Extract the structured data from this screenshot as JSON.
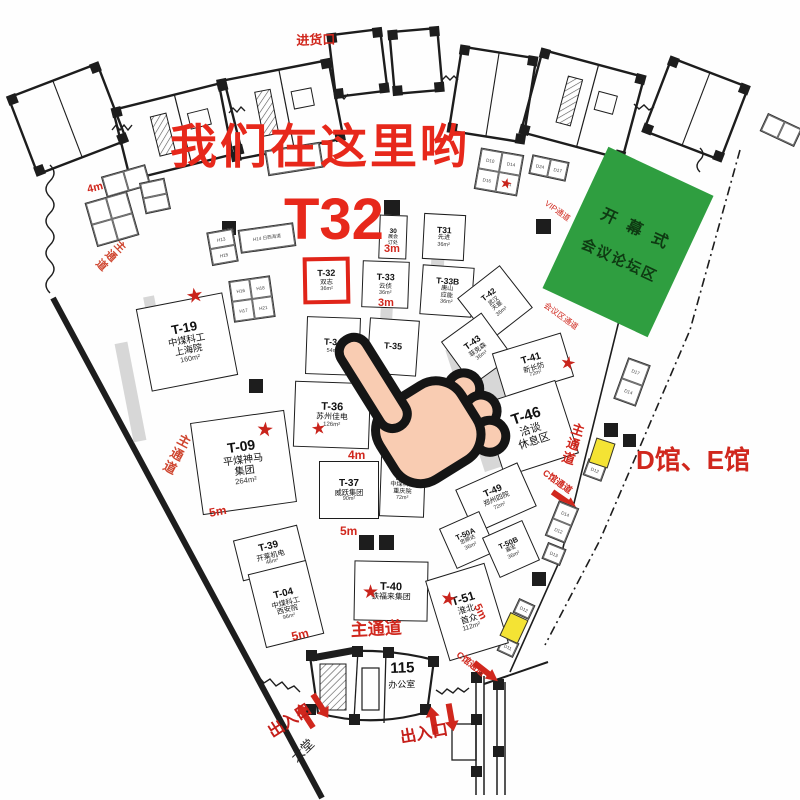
{
  "colors": {
    "accent_red": "#d0271d",
    "highlight_red": "#e02419",
    "green_area": "#2f9e40",
    "yellow_booth": "#f4e334"
  },
  "annotations": {
    "headline": "我们在这里哟",
    "booth_code": "T32"
  },
  "green_area": {
    "line1": "开幕式",
    "line2": "会议论坛区"
  },
  "booths": [
    {
      "id": "T-19",
      "n": [
        "中煤科工",
        "上海院"
      ],
      "a": "160m²",
      "x": 143,
      "y": 300,
      "w": 88,
      "h": 84,
      "r": -11,
      "fs": 13
    },
    {
      "id": "T-09",
      "n": [
        "平煤神马",
        "集团"
      ],
      "a": "264m²",
      "x": 196,
      "y": 416,
      "w": 95,
      "h": 93,
      "r": -8,
      "fs": 14
    },
    {
      "id": "T-39",
      "n": [
        "开莱机电"
      ],
      "a": "48m²",
      "x": 237,
      "y": 532,
      "w": 66,
      "h": 42,
      "r": -14,
      "fs": 10
    },
    {
      "id": "T-04",
      "n": [
        "中煤科工",
        "西安院"
      ],
      "a": "96m²",
      "x": 256,
      "y": 566,
      "w": 60,
      "h": 76,
      "r": -14,
      "fs": 10
    },
    {
      "id": "30",
      "n": [
        "展会",
        "订处"
      ],
      "a": "",
      "x": 379,
      "y": 215,
      "w": 28,
      "h": 44,
      "r": 2,
      "fs": 6.5
    },
    {
      "id": "T31",
      "n": [
        "先进"
      ],
      "a": "36m²",
      "x": 423,
      "y": 214,
      "w": 42,
      "h": 46,
      "r": 3,
      "fs": 8.5
    },
    {
      "id": "T-32",
      "n": [
        "双志"
      ],
      "a": "36m²",
      "x": 303,
      "y": 257,
      "w": 47,
      "h": 47,
      "r": -1,
      "fs": 9,
      "hl": true
    },
    {
      "id": "T-33",
      "n": [
        "云侦"
      ],
      "a": "36m²",
      "x": 362,
      "y": 261,
      "w": 47,
      "h": 47,
      "r": 2,
      "fs": 9
    },
    {
      "id": "T-33B",
      "n": [
        "唐山",
        "应能"
      ],
      "a": "36m²",
      "x": 421,
      "y": 266,
      "w": 52,
      "h": 50,
      "r": 4,
      "fs": 8.5
    },
    {
      "id": "T-42",
      "n": [
        "武汉",
        "天宸"
      ],
      "a": "36m²",
      "x": 468,
      "y": 276,
      "w": 54,
      "h": 54,
      "r": -38,
      "fs": 8
    },
    {
      "id": "T-34",
      "n": [],
      "a": "54m²",
      "x": 306,
      "y": 317,
      "w": 54,
      "h": 58,
      "r": 2,
      "fs": 9
    },
    {
      "id": "T-35",
      "n": [],
      "a": "",
      "x": 368,
      "y": 319,
      "w": 50,
      "h": 56,
      "r": 4,
      "fs": 9
    },
    {
      "id": "T-36",
      "n": [
        "苏州佳电"
      ],
      "a": "126m²",
      "x": 294,
      "y": 382,
      "w": 76,
      "h": 66,
      "r": 2,
      "fs": 11
    },
    {
      "id": "T-37",
      "n": [
        "威跃集团"
      ],
      "a": "90m²",
      "x": 319,
      "y": 461,
      "w": 60,
      "h": 58,
      "r": 0,
      "fs": 10
    },
    {
      "id": "T-38",
      "n": [
        "中煤科工",
        "重庆院"
      ],
      "a": "72m²",
      "x": 380,
      "y": 457,
      "w": 45,
      "h": 60,
      "r": 2,
      "fs": 8.5
    },
    {
      "id": "T-40",
      "n": [
        "铁福来集团"
      ],
      "a": "",
      "x": 354,
      "y": 561,
      "w": 74,
      "h": 60,
      "r": 1,
      "fs": 11
    },
    {
      "id": "T-43",
      "n": [
        "菲克森"
      ],
      "a": "36m²",
      "x": 452,
      "y": 322,
      "w": 50,
      "h": 54,
      "r": -36,
      "fs": 9
    },
    {
      "id": "T-41",
      "n": [
        "新长防"
      ],
      "a": "72m²",
      "x": 497,
      "y": 342,
      "w": 72,
      "h": 46,
      "r": -17,
      "fs": 10
    },
    {
      "id": "T-46",
      "n": [
        "洽谈",
        "休息区"
      ],
      "a": "",
      "x": 491,
      "y": 390,
      "w": 78,
      "h": 77,
      "r": -18,
      "fs": 15
    },
    {
      "id": "T-49",
      "n": [
        "郑州四院"
      ],
      "a": "72m²",
      "x": 462,
      "y": 474,
      "w": 68,
      "h": 48,
      "r": -24,
      "fs": 9.5
    },
    {
      "id": "T-50A",
      "n": [
        "忠顺达"
      ],
      "a": "36m²",
      "x": 446,
      "y": 518,
      "w": 44,
      "h": 44,
      "r": -24,
      "fs": 7.5
    },
    {
      "id": "T-50B",
      "n": [
        "嘉宏"
      ],
      "a": "36m²",
      "x": 489,
      "y": 527,
      "w": 44,
      "h": 44,
      "r": -24,
      "fs": 7.5
    },
    {
      "id": "T-51",
      "n": [
        "淮北",
        "首众"
      ],
      "a": "112m²",
      "x": 436,
      "y": 570,
      "w": 62,
      "h": 84,
      "r": -17,
      "fs": 12
    }
  ],
  "mini_clusters": [
    {
      "cells": [
        "",
        ""
      ],
      "cols": 2,
      "x": 103,
      "y": 170,
      "w": 46,
      "h": 22,
      "r": -16
    },
    {
      "cells": [
        "",
        "",
        "",
        ""
      ],
      "cols": 2,
      "x": 90,
      "y": 196,
      "w": 44,
      "h": 46,
      "r": -16
    },
    {
      "cells": [
        "",
        ""
      ],
      "cols": 1,
      "x": 142,
      "y": 180,
      "w": 26,
      "h": 32,
      "r": -12
    },
    {
      "cells": [
        ""
      ],
      "cols": 1,
      "x": 266,
      "y": 146,
      "w": 56,
      "h": 26,
      "r": -9
    },
    {
      "cells": [
        "H13",
        "H15"
      ],
      "cols": 1,
      "x": 209,
      "y": 230,
      "w": 27,
      "h": 34,
      "r": -10
    },
    {
      "cells": [
        "H14 日西海道"
      ],
      "cols": 1,
      "x": 239,
      "y": 226,
      "w": 56,
      "h": 24,
      "r": -8
    },
    {
      "cells": [
        "H16",
        "H18",
        "H17",
        "H21"
      ],
      "cols": 2,
      "x": 231,
      "y": 278,
      "w": 42,
      "h": 42,
      "r": -8
    },
    {
      "cells": [
        "D10",
        "D14",
        "D16",
        "D11"
      ],
      "cols": 2,
      "x": 477,
      "y": 151,
      "w": 44,
      "h": 42,
      "r": 10
    },
    {
      "cells": [
        "D24",
        "D17"
      ],
      "cols": 2,
      "x": 530,
      "y": 158,
      "w": 38,
      "h": 20,
      "r": 12
    },
    {
      "cells": [
        "D17",
        "D14"
      ],
      "cols": 1,
      "x": 620,
      "y": 360,
      "w": 24,
      "h": 44,
      "r": 20
    },
    {
      "cells": [
        "D12"
      ],
      "cols": 1,
      "x": 585,
      "y": 461,
      "w": 20,
      "h": 18,
      "r": 20
    },
    {
      "cells": [
        "D14",
        "D12"
      ],
      "cols": 1,
      "x": 551,
      "y": 503,
      "w": 22,
      "h": 38,
      "r": 22
    },
    {
      "cells": [
        "D13"
      ],
      "cols": 1,
      "x": 544,
      "y": 545,
      "w": 20,
      "h": 18,
      "r": 22
    },
    {
      "cells": [
        "D12"
      ],
      "cols": 1,
      "x": 515,
      "y": 601,
      "w": 18,
      "h": 16,
      "r": 25
    },
    {
      "cells": [
        "D11"
      ],
      "cols": 1,
      "x": 499,
      "y": 639,
      "w": 18,
      "h": 16,
      "r": 25
    },
    {
      "cells": [
        "",
        ""
      ],
      "cols": 2,
      "x": 762,
      "y": 120,
      "w": 38,
      "h": 20,
      "r": 25
    }
  ],
  "yellow_booths": [
    {
      "x": 592,
      "y": 440,
      "w": 20,
      "h": 26,
      "r": 18
    },
    {
      "x": 504,
      "y": 615,
      "w": 20,
      "h": 26,
      "r": 25
    }
  ],
  "stars": [
    {
      "x": 186,
      "y": 286,
      "s": 20,
      "r": -10
    },
    {
      "x": 256,
      "y": 420,
      "s": 20,
      "r": 5
    },
    {
      "x": 311,
      "y": 420,
      "s": 17,
      "r": -8
    },
    {
      "x": 560,
      "y": 354,
      "s": 18,
      "r": 10
    },
    {
      "x": 362,
      "y": 583,
      "s": 19,
      "r": 0
    },
    {
      "x": 440,
      "y": 590,
      "s": 19,
      "r": 10
    },
    {
      "x": 500,
      "y": 176,
      "s": 14,
      "r": 15
    }
  ],
  "labels": [
    {
      "t": "进货口",
      "x": 296,
      "y": 30,
      "s": 13,
      "c": "#d0271d",
      "rot": -2,
      "b": 1
    },
    {
      "t": "主通道",
      "x": 118,
      "y": 236,
      "s": 11,
      "c": "#cf4630",
      "rot": 45,
      "b": 1,
      "v": 1
    },
    {
      "t": "主通道",
      "x": 178,
      "y": 430,
      "s": 13,
      "c": "#cf4630",
      "rot": 28,
      "b": 1,
      "v": 1
    },
    {
      "t": "主通道",
      "x": 350,
      "y": 616,
      "s": 17,
      "c": "#d0271d",
      "rot": -3,
      "b": 1
    },
    {
      "t": "主通道",
      "x": 570,
      "y": 420,
      "s": 13,
      "c": "#d0271d",
      "rot": 18,
      "b": 1,
      "v": 1
    },
    {
      "t": "C馆通道",
      "x": 548,
      "y": 466,
      "s": 9,
      "c": "#d0271d",
      "rot": 36,
      "b": 1
    },
    {
      "t": "C馆通道",
      "x": 462,
      "y": 648,
      "s": 9,
      "c": "#d0271d",
      "rot": 38,
      "b": 1
    },
    {
      "t": "会议区通道",
      "x": 548,
      "y": 300,
      "s": 8,
      "c": "#d0271d",
      "rot": 36,
      "b": 0
    },
    {
      "t": "VIP通道",
      "x": 549,
      "y": 198,
      "s": 8,
      "c": "#d0271d",
      "rot": 36,
      "b": 0
    },
    {
      "t": "D馆、E馆",
      "x": 636,
      "y": 440,
      "s": 26,
      "c": "#d0271d",
      "rot": 0,
      "b": 1
    },
    {
      "t": "出入口",
      "x": 262,
      "y": 722,
      "s": 16,
      "c": "#c51f1a",
      "rot": -33,
      "b": 1
    },
    {
      "t": "出入口",
      "x": 398,
      "y": 724,
      "s": 16,
      "c": "#c51f1a",
      "rot": -10,
      "b": 1
    },
    {
      "t": "大堂",
      "x": 286,
      "y": 752,
      "s": 13,
      "c": "#222222",
      "rot": -44,
      "b": 0
    },
    {
      "t": "115",
      "x": 390,
      "y": 660,
      "s": 15,
      "c": "#111111",
      "rot": -2,
      "b": 1
    },
    {
      "t": "办公室",
      "x": 388,
      "y": 678,
      "s": 9,
      "c": "#111111",
      "rot": -2,
      "b": 0
    },
    {
      "t": "4m",
      "x": 86,
      "y": 184,
      "s": 11,
      "c": "#d0271d",
      "rot": -14,
      "b": 1
    },
    {
      "t": "4m",
      "x": 348,
      "y": 448,
      "s": 12,
      "c": "#d0271d",
      "rot": 0,
      "b": 1
    },
    {
      "t": "3m",
      "x": 384,
      "y": 243,
      "s": 11,
      "c": "#d0271d",
      "rot": 0,
      "b": 1
    },
    {
      "t": "3m",
      "x": 378,
      "y": 297,
      "s": 11,
      "c": "#d0271d",
      "rot": 0,
      "b": 1
    },
    {
      "t": "5m",
      "x": 208,
      "y": 506,
      "s": 12,
      "c": "#d0271d",
      "rot": -10,
      "b": 1
    },
    {
      "t": "5m",
      "x": 340,
      "y": 524,
      "s": 12,
      "c": "#d0271d",
      "rot": 0,
      "b": 1
    },
    {
      "t": "5m",
      "x": 290,
      "y": 630,
      "s": 12,
      "c": "#d0271d",
      "rot": -14,
      "b": 1
    },
    {
      "t": "5m",
      "x": 482,
      "y": 602,
      "s": 11,
      "c": "#d0271d",
      "rot": 64,
      "b": 1
    }
  ]
}
